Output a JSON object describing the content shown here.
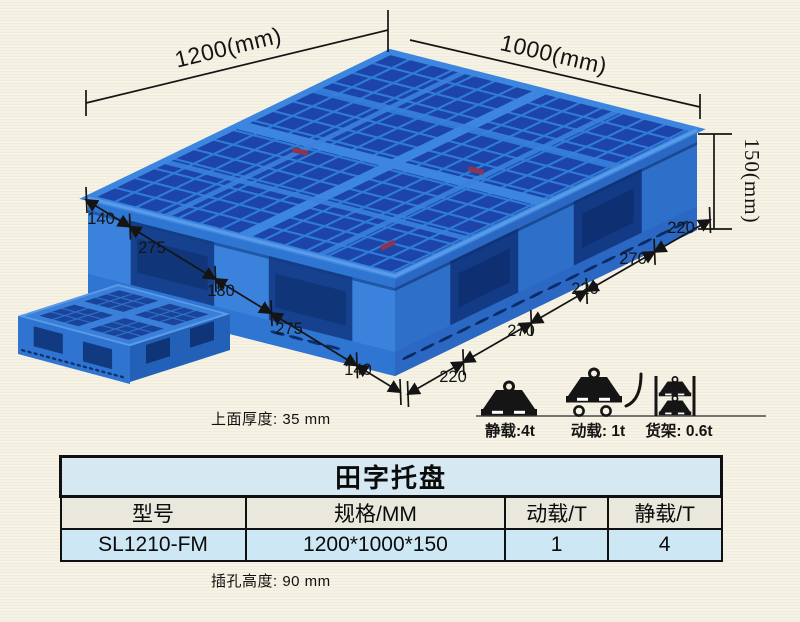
{
  "diagram": {
    "top_width_label": "1200(mm)",
    "top_depth_label": "1000(mm)",
    "height_label": "150(mm)",
    "left_edge_dims": [
      "140",
      "275",
      "180",
      "275",
      "140"
    ],
    "right_edge_dims": [
      "220",
      "270",
      "220",
      "270",
      "220"
    ],
    "thickness_notes": [
      "上面厚度: 35 mm",
      "下面厚度: 25 mm",
      "插孔高度: 90 mm"
    ]
  },
  "load_icons": [
    {
      "name": "static-load",
      "label": "静载:4t"
    },
    {
      "name": "dynamic-load",
      "label": "动载: 1t"
    },
    {
      "name": "rack-load",
      "label": "货架: 0.6t"
    }
  ],
  "table": {
    "title": "田字托盘",
    "headers": [
      "型号",
      "规格/MM",
      "动载/T",
      "静载/T"
    ],
    "rows": [
      [
        "SL1210-FM",
        "1200*1000*150",
        "1",
        "4"
      ]
    ]
  },
  "colors": {
    "pallet_blue": "#2f7ad6",
    "pallet_dark": "#16418f",
    "table_title_bg": "#d6e8f2",
    "table_header_bg": "#eae8dd",
    "table_data_bg": "#cde7f4",
    "background": "#f6f3e6"
  }
}
